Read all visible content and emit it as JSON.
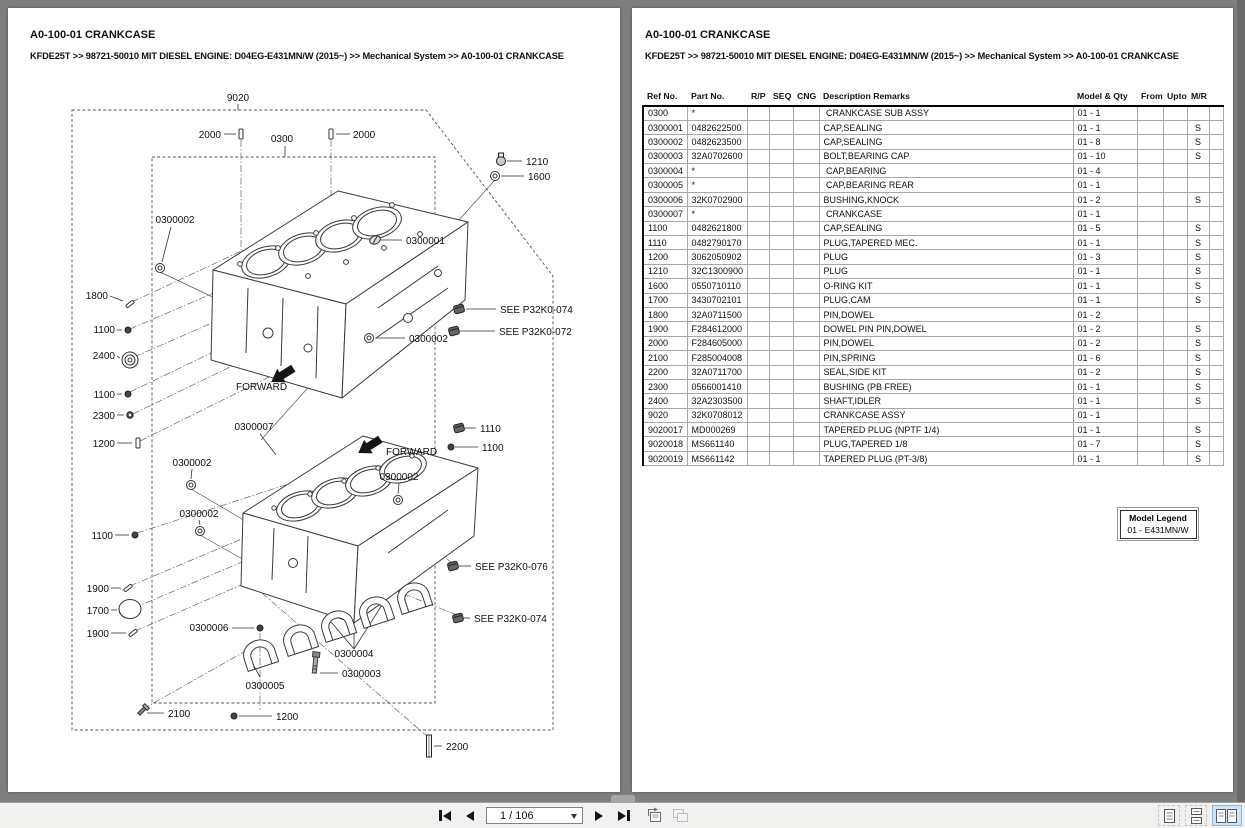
{
  "header": {
    "title": "A0-100-01 CRANKCASE",
    "breadcrumb": "KFDE25T >> 98721-50010 MIT DIESEL ENGINE: D04EG-E431MN/W (2015~) >> Mechanical System >> A0-100-01 CRANKCASE"
  },
  "table": {
    "headers": [
      "Ref No.",
      "Part No.",
      "R/P",
      "SEQ",
      "CNG",
      "Description Remarks",
      "Model & Qty",
      "From",
      "Upto",
      "M/R"
    ],
    "rows": [
      {
        "ref": "0300",
        "part": "*",
        "desc": " CRANKCASE SUB ASSY",
        "qty": "01 - 1",
        "mr": ""
      },
      {
        "ref": "0300001",
        "part": "0482622500",
        "desc": "CAP,SEALING",
        "qty": "01 - 1",
        "mr": "S"
      },
      {
        "ref": "0300002",
        "part": "0482623500",
        "desc": "CAP,SEALING",
        "qty": "01 - 8",
        "mr": "S"
      },
      {
        "ref": "0300003",
        "part": "32A0702600",
        "desc": "BOLT,BEARING CAP",
        "qty": "01 - 10",
        "mr": "S"
      },
      {
        "ref": "0300004",
        "part": "*",
        "desc": " CAP,BEARING",
        "qty": "01 - 4",
        "mr": ""
      },
      {
        "ref": "0300005",
        "part": "*",
        "desc": " CAP,BEARING REAR",
        "qty": "01 - 1",
        "mr": ""
      },
      {
        "ref": "0300006",
        "part": "32K0702900",
        "desc": "BUSHING,KNOCK",
        "qty": "01 - 2",
        "mr": "S"
      },
      {
        "ref": "0300007",
        "part": "*",
        "desc": " CRANKCASE",
        "qty": "01 - 1",
        "mr": ""
      },
      {
        "ref": "1100",
        "part": "0482621800",
        "desc": "CAP,SEALING",
        "qty": "01 - 5",
        "mr": "S"
      },
      {
        "ref": "1110",
        "part": "0482790170",
        "desc": "PLUG,TAPERED MEC.",
        "qty": "01 - 1",
        "mr": "S"
      },
      {
        "ref": "1200",
        "part": "3062050902",
        "desc": "PLUG",
        "qty": "01 - 3",
        "mr": "S"
      },
      {
        "ref": "1210",
        "part": "32C1300900",
        "desc": "PLUG",
        "qty": "01 - 1",
        "mr": "S"
      },
      {
        "ref": "1600",
        "part": "0550710110",
        "desc": "O-RING KIT",
        "qty": "01 - 1",
        "mr": "S"
      },
      {
        "ref": "1700",
        "part": "3430702101",
        "desc": "PLUG,CAM",
        "qty": "01 - 1",
        "mr": "S"
      },
      {
        "ref": "1800",
        "part": "32A0711500",
        "desc": "PIN,DOWEL",
        "qty": "01 - 2",
        "mr": ""
      },
      {
        "ref": "1900",
        "part": "F284612000",
        "desc": "DOWEL PIN PIN,DOWEL",
        "qty": "01 - 2",
        "mr": "S"
      },
      {
        "ref": "2000",
        "part": "F284605000",
        "desc": "PIN,DOWEL",
        "qty": "01 - 2",
        "mr": "S"
      },
      {
        "ref": "2100",
        "part": "F285004008",
        "desc": "PIN,SPRING",
        "qty": "01 - 6",
        "mr": "S"
      },
      {
        "ref": "2200",
        "part": "32A0711700",
        "desc": "SEAL,SIDE KIT",
        "qty": "01 - 2",
        "mr": "S"
      },
      {
        "ref": "2300",
        "part": "0566001410",
        "desc": "BUSHING (PB FREE)",
        "qty": "01 - 1",
        "mr": "S"
      },
      {
        "ref": "2400",
        "part": "32A2303500",
        "desc": "SHAFT,IDLER",
        "qty": "01 - 1",
        "mr": "S"
      },
      {
        "ref": "9020",
        "part": "32K0708012",
        "desc": "CRANKCASE ASSY",
        "qty": "01 - 1",
        "mr": ""
      },
      {
        "ref": "9020017",
        "part": "MD000269",
        "desc": "TAPERED PLUG (NPTF 1/4)",
        "qty": "01 - 1",
        "mr": "S"
      },
      {
        "ref": "9020018",
        "part": "MS661140",
        "desc": "PLUG,TAPERED 1/8",
        "qty": "01 - 7",
        "mr": "S"
      },
      {
        "ref": "9020019",
        "part": "MS661142",
        "desc": "TAPERED PLUG (PT-3/8)",
        "qty": "01 - 1",
        "mr": "S"
      }
    ]
  },
  "model_legend": {
    "title": "Model Legend",
    "entry": "01 - E431MN/W"
  },
  "diagram": {
    "callouts": [
      {
        "t": "9020",
        "x": 230,
        "y": 93,
        "a": "middle",
        "line": [
          230,
          96,
          230,
          102
        ]
      },
      {
        "t": "2000",
        "x": 213,
        "y": 130,
        "a": "end",
        "g": "pin",
        "gx": 233,
        "gy": 126,
        "line": [
          216,
          126,
          228,
          126
        ]
      },
      {
        "t": "0300",
        "x": 274,
        "y": 134,
        "a": "middle",
        "line": [
          277,
          138,
          277,
          149
        ]
      },
      {
        "t": "2000",
        "x": 345,
        "y": 130,
        "a": "start",
        "g": "pin",
        "gx": 323,
        "gy": 126,
        "line": [
          328,
          126,
          342,
          126
        ]
      },
      {
        "t": "1210",
        "x": 518,
        "y": 157,
        "a": "start",
        "g": "plugcircle",
        "gx": 493,
        "gy": 153,
        "line": [
          499,
          153,
          514,
          153
        ]
      },
      {
        "t": "1600",
        "x": 520,
        "y": 172,
        "a": "start",
        "g": "ring",
        "gx": 487,
        "gy": 168,
        "line": [
          493,
          168,
          516,
          168
        ]
      },
      {
        "t": "0300002",
        "x": 167,
        "y": 215,
        "a": "middle",
        "g": "ring",
        "gx": 152,
        "gy": 260,
        "line": [
          163,
          219,
          154,
          254
        ]
      },
      {
        "t": "0300001",
        "x": 398,
        "y": 236,
        "a": "start",
        "g": "cap",
        "gx": 367,
        "gy": 232,
        "line": [
          373,
          232,
          394,
          232
        ]
      },
      {
        "t": "1800",
        "x": 100,
        "y": 291,
        "a": "end",
        "g": "pinangled",
        "gx": 122,
        "gy": 296,
        "line": [
          102,
          288,
          115,
          293
        ]
      },
      {
        "t": "SEE P32K0-074",
        "x": 492,
        "y": 305,
        "a": "start",
        "g": "plug",
        "gx": 451,
        "gy": 301,
        "line": [
          458,
          301,
          488,
          301
        ]
      },
      {
        "t": "SEE P32K0-072",
        "x": 491,
        "y": 327,
        "a": "start",
        "g": "plug",
        "gx": 446,
        "gy": 323,
        "line": [
          452,
          323,
          487,
          323
        ]
      },
      {
        "t": "1100",
        "x": 107,
        "y": 325,
        "a": "end",
        "g": "dot",
        "gx": 120,
        "gy": 322,
        "line": [
          109,
          322,
          114,
          322
        ]
      },
      {
        "t": "2400",
        "x": 107,
        "y": 351,
        "a": "end",
        "g": "idler",
        "gx": 122,
        "gy": 352,
        "line": [
          109,
          348,
          112,
          350
        ]
      },
      {
        "t": "0300002",
        "x": 401,
        "y": 334,
        "a": "start",
        "g": "ring",
        "gx": 361,
        "gy": 330,
        "line": [
          367,
          330,
          397,
          330
        ]
      },
      {
        "t": "1100",
        "x": 107,
        "y": 390,
        "a": "end",
        "g": "dot",
        "gx": 120,
        "gy": 386,
        "line": [
          109,
          386,
          114,
          386
        ]
      },
      {
        "t": "2300",
        "x": 107,
        "y": 411,
        "a": "end",
        "g": "dot2",
        "gx": 122,
        "gy": 407,
        "line": [
          109,
          407,
          116,
          407
        ]
      },
      {
        "t": "1200",
        "x": 107,
        "y": 439,
        "a": "end",
        "g": "pin",
        "gx": 130,
        "gy": 435,
        "line": [
          109,
          435,
          124,
          435
        ]
      },
      {
        "t": "0300007",
        "x": 246,
        "y": 422,
        "a": "middle",
        "line": [
          252,
          426,
          268,
          447
        ]
      },
      {
        "t": "FORWARD",
        "x": 228,
        "y": 382,
        "a": "start",
        "g": "arrow",
        "gx": 276,
        "gy": 366
      },
      {
        "t": "0300002",
        "x": 184,
        "y": 458,
        "a": "middle",
        "g": "ring",
        "gx": 183,
        "gy": 477,
        "line": [
          184,
          461,
          183,
          471
        ]
      },
      {
        "t": "0300002",
        "x": 191,
        "y": 509,
        "a": "middle",
        "g": "ring",
        "gx": 192,
        "gy": 523,
        "line": [
          191,
          512,
          192,
          517
        ]
      },
      {
        "t": "FORWARD",
        "x": 378,
        "y": 447,
        "a": "start",
        "g": "arrow",
        "gx": 363,
        "gy": 437
      },
      {
        "t": "0300002",
        "x": 391,
        "y": 472,
        "a": "middle",
        "g": "ring",
        "gx": 390,
        "gy": 492,
        "line": [
          391,
          475,
          390,
          486
        ]
      },
      {
        "t": "1110",
        "x": 472,
        "y": 424,
        "a": "start",
        "g": "plug",
        "gx": 451,
        "gy": 420,
        "line": [
          457,
          420,
          468,
          420
        ]
      },
      {
        "t": "1100",
        "x": 474,
        "y": 443,
        "a": "start",
        "g": "dot",
        "gx": 443,
        "gy": 439,
        "line": [
          447,
          439,
          470,
          439
        ]
      },
      {
        "t": "1100",
        "x": 105,
        "y": 531,
        "a": "end",
        "g": "dot",
        "gx": 127,
        "gy": 527,
        "line": [
          107,
          527,
          121,
          527
        ]
      },
      {
        "t": "1900",
        "x": 101,
        "y": 584,
        "a": "end",
        "g": "pinangled",
        "gx": 120,
        "gy": 580,
        "line": [
          103,
          580,
          113,
          580
        ]
      },
      {
        "t": "1700",
        "x": 101,
        "y": 606,
        "a": "end",
        "g": "bigcyl",
        "gx": 122,
        "gy": 601,
        "line": [
          103,
          602,
          109,
          602
        ]
      },
      {
        "t": "1900",
        "x": 101,
        "y": 629,
        "a": "end",
        "g": "pinangled",
        "gx": 125,
        "gy": 625,
        "line": [
          103,
          625,
          118,
          625
        ]
      },
      {
        "t": "0300006",
        "x": 201,
        "y": 623,
        "a": "middle",
        "g": "dot",
        "gx": 252,
        "gy": 620,
        "line": [
          224,
          620,
          246,
          620
        ]
      },
      {
        "t": "0300005",
        "x": 257,
        "y": 681,
        "a": "middle",
        "line": [
          252,
          669,
          246,
          658
        ]
      },
      {
        "t": "0300004",
        "x": 346,
        "y": 649,
        "a": "middle"
      },
      {
        "t": "0300003",
        "x": 334,
        "y": 669,
        "a": "start",
        "line": [
          312,
          665,
          330,
          665
        ]
      },
      {
        "t": "2100",
        "x": 160,
        "y": 709,
        "a": "start",
        "g": "screw",
        "gx": 133,
        "gy": 704,
        "line": [
          139,
          705,
          156,
          705
        ]
      },
      {
        "t": "1200",
        "x": 268,
        "y": 712,
        "a": "start",
        "g": "dot",
        "gx": 226,
        "gy": 708,
        "line": [
          231,
          708,
          264,
          708
        ]
      },
      {
        "t": "SEE P32K0-076",
        "x": 467,
        "y": 562,
        "a": "start",
        "g": "plug",
        "gx": 445,
        "gy": 558,
        "line": [
          451,
          558,
          463,
          558
        ]
      },
      {
        "t": "SEE P32K0-074",
        "x": 466,
        "y": 614,
        "a": "start",
        "g": "plug",
        "gx": 450,
        "gy": 610,
        "line": [
          456,
          610,
          462,
          610
        ]
      },
      {
        "t": "2200",
        "x": 438,
        "y": 742,
        "a": "start",
        "g": "barv",
        "gx": 421,
        "gy": 738,
        "line": [
          426,
          738,
          434,
          738
        ]
      }
    ]
  },
  "toolbar": {
    "page_indicator": "1 / 106",
    "icons": {
      "first_page": "first-page",
      "prev_page": "previous-page",
      "next_page": "next-page",
      "last_page": "last-page",
      "prev_view": "previous-view",
      "next_view": "next-view",
      "single_page": "single-page-view",
      "continuous": "continuous-view",
      "two_page": "two-page-view"
    }
  }
}
